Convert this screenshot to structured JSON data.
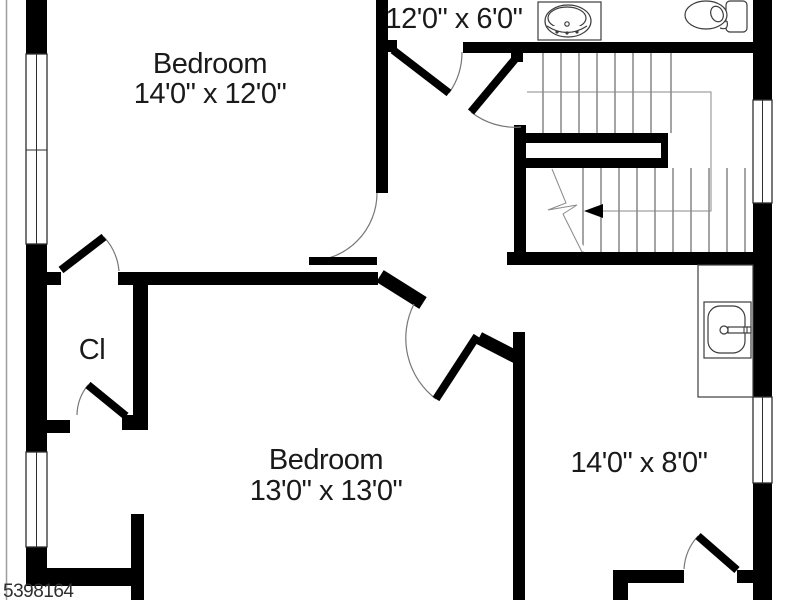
{
  "plan": {
    "colors": {
      "wall": "#000000",
      "line": "#3c3c3c",
      "arc": "#777777",
      "bg": "#ffffff",
      "text": "#1a1a1a",
      "watermark": "#2f2f2f",
      "edge": "#9e9e9e"
    },
    "rooms": {
      "bedroom1": {
        "name": "Bedroom",
        "dims": "14'0\" x 12'0\""
      },
      "bathroom": {
        "dims": "12'0\" x 6'0\""
      },
      "closet": {
        "name": "Cl"
      },
      "bedroom2": {
        "name": "Bedroom",
        "dims": "13'0\" x 13'0\""
      },
      "flex": {
        "dims": "14'0\" x 8'0\""
      }
    },
    "fixtures": {
      "bathroom_sink": "sink-icon",
      "toilet": "toilet-icon",
      "vanity_sink": "sink-icon",
      "stairs": "staircase-up"
    },
    "watermark": "5398164"
  }
}
